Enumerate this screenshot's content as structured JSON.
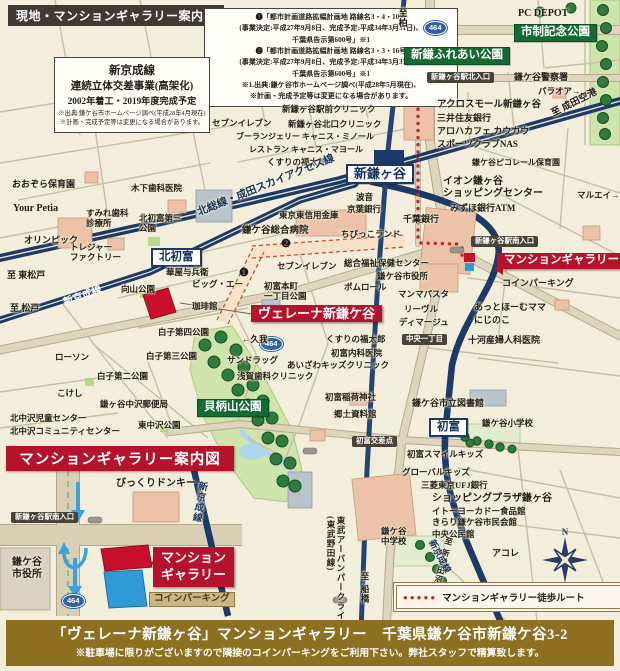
{
  "header": {
    "map_title": "現地・マンションギャラリー案内図"
  },
  "notes": {
    "roads_lines": [
      "❶「都市計画道路拡幅計画地 路線名3・4・10号",
      "(事業決定:平成27年9月8日、完成予定:平成34年3月31日)、",
      "千葉県告示第600号」※1",
      "❷「都市計画道路拡幅計画地 路線名3・3・16号",
      "(事業決定:平成27年9月8日、完成予定:平成34年3月31日)、",
      "千葉県告示第600号」※1",
      "※1.出典:鎌ケ谷市ホームページ調べ(平成28年5月現在)、",
      "※計画・完成予定等は変更になる場合があります。"
    ],
    "rail_t1": "新京成線",
    "rail_t2": "連続立体交差事業(高架化)",
    "rail_t3": "2002年着工・2019年度完成予定",
    "rail_small": [
      "※出典:鎌ケ谷市ホームページ調べ(平成28年4月現在)",
      "※計画・完成予定等は変更になる場合があります。"
    ]
  },
  "inset": {
    "title": "マンションギャラリー案内図",
    "gallery_label": "マンション\nギャラリー"
  },
  "legend": {
    "dots": "●●●●●",
    "text": "マンションギャラリー徒歩ルート"
  },
  "compass": {
    "n": "N"
  },
  "footer": {
    "line1": "「ヴェレーナ新鎌ヶ谷」マンションギャラリー　千葉県鎌ケ谷市新鎌ケ谷3-2",
    "line2": "※駐車場に限りがございますので隣接のコインパーキングをご利用下さい。弊社スタッフで精算致します。"
  },
  "colors": {
    "rail_navy": "#1d3a66",
    "route_red": "#c32b2b",
    "site_red": "#c8102e",
    "accent_crimson": "#b5122b",
    "park_green": "#cfe3ad",
    "label_green_bg": "#156a33",
    "badge_dark": "#494337",
    "footer_gold": "#8d7021",
    "coin_blue": "#2e9bd6",
    "shield_blue": "#2f61a8",
    "bg_cream": "#f3eedb"
  },
  "labels": [
    {
      "t": "PC DEPOT",
      "x": 518,
      "y": 8,
      "fs": 10,
      "cls": "b"
    },
    {
      "t": "市制記念公園",
      "x": 514,
      "y": 24,
      "cls": "green",
      "n": "park-label-shisei-kinen"
    },
    {
      "t": "新鎌ふれあい公園",
      "x": 404,
      "y": 47,
      "cls": "green",
      "n": "park-label-shinkama-fureai"
    },
    {
      "t": "貝柄山公園",
      "x": 197,
      "y": 399,
      "cls": "green",
      "n": "park-label-kaigarayama"
    },
    {
      "t": "新鎌ヶ谷",
      "x": 346,
      "y": 164,
      "cls": "station",
      "fs": 13,
      "n": "station-shinkamagaya"
    },
    {
      "t": "北初富",
      "x": 151,
      "y": 248,
      "cls": "station",
      "fs": 11.5,
      "n": "station-kitahatsutomi"
    },
    {
      "t": "初富",
      "x": 429,
      "y": 418,
      "cls": "station",
      "fs": 11.5,
      "n": "station-hatsutomi"
    },
    {
      "t": "新鎌ヶ谷駅北入口",
      "x": 427,
      "y": 72,
      "cls": "badge",
      "n": "intersection-badge-north"
    },
    {
      "t": "新鎌ヶ谷駅南入口",
      "x": 471,
      "y": 236,
      "cls": "badge",
      "n": "intersection-badge-south"
    },
    {
      "t": "中央一丁目",
      "x": 402,
      "y": 334,
      "cls": "badge",
      "n": "intersection-badge-chuo"
    },
    {
      "t": "初富交差点",
      "x": 352,
      "y": 436,
      "cls": "badge",
      "n": "intersection-badge-hatsutomi"
    },
    {
      "t": "新鎌ヶ谷駅南入口",
      "x": 11,
      "y": 512,
      "cls": "badge",
      "n": "intersection-badge-south-inset"
    },
    {
      "t": "ヴェレーナ新鎌ケ谷",
      "x": 251,
      "y": 305,
      "cls": "red",
      "fs": 13,
      "n": "property-label"
    },
    {
      "t": "マンションギャラリー",
      "x": 497,
      "y": 253,
      "cls": "red pt-left",
      "fs": 11.5,
      "n": "gallery-label"
    },
    {
      "t": "コインパーキング",
      "x": 149,
      "y": 592,
      "cls": "tanbadge",
      "n": "coin-parking-label-inset"
    },
    {
      "t": "464",
      "x": 424,
      "y": 21,
      "cls": "shield",
      "n": "route-shield-464"
    },
    {
      "t": "464",
      "x": 260,
      "y": 337,
      "cls": "shield",
      "n": "route-shield-464"
    },
    {
      "t": "464",
      "x": 62,
      "y": 594,
      "cls": "shield",
      "n": "route-shield-464"
    },
    {
      "t": "❶",
      "x": 239,
      "y": 267,
      "cls": "circ",
      "n": "plan-marker-1"
    },
    {
      "t": "❷",
      "x": 281,
      "y": 238,
      "cls": "circ",
      "n": "plan-marker-2"
    },
    {
      "t": "鎌ケ谷警察署",
      "x": 514,
      "y": 72,
      "fs": 9
    },
    {
      "t": "パラオア→",
      "x": 538,
      "y": 86
    },
    {
      "t": "アクロスモール新鎌ヶ谷",
      "x": 437,
      "y": 100,
      "fs": 9.5
    },
    {
      "t": "三井住友銀行",
      "x": 437,
      "y": 113,
      "fs": 9
    },
    {
      "t": "アロハカフェ カウカウ",
      "x": 437,
      "y": 126,
      "fs": 9
    },
    {
      "t": "スポーツクラブNAS",
      "x": 437,
      "y": 139,
      "fs": 9
    },
    {
      "t": "鎌ケ谷ピコレール保育園",
      "x": 472,
      "y": 158,
      "fs": 8
    },
    {
      "t": "マルエイ→",
      "x": 577,
      "y": 190
    },
    {
      "t": "イオン鎌ヶ谷\nショッピングセンター",
      "x": 443,
      "y": 176,
      "fs": 10
    },
    {
      "t": "みずほ銀行ATM",
      "x": 450,
      "y": 203,
      "fs": 9
    },
    {
      "t": "千葉銀行",
      "x": 403,
      "y": 214,
      "fs": 9
    },
    {
      "t": "波音",
      "x": 356,
      "y": 192
    },
    {
      "t": "京葉銀行",
      "x": 347,
      "y": 204
    },
    {
      "t": "東京東信用金庫",
      "x": 279,
      "y": 210
    },
    {
      "t": "鎌ケ谷総合病院",
      "x": 242,
      "y": 226,
      "fs": 9.5
    },
    {
      "t": "ちびっこランド",
      "x": 341,
      "y": 229
    },
    {
      "t": "セブンイレブン",
      "x": 212,
      "y": 118
    },
    {
      "t": "新鎌ヶ谷駅前クリニック",
      "x": 282,
      "y": 104
    },
    {
      "t": "新鎌ヶ谷北口クリニック",
      "x": 288,
      "y": 119
    },
    {
      "t": "ブーランジェリー キャニス・ミノール",
      "x": 236,
      "y": 132,
      "fs": 8
    },
    {
      "t": "レストラン キャニス・マヨール",
      "x": 249,
      "y": 145,
      "fs": 8
    },
    {
      "t": "くすりの福太郎",
      "x": 267,
      "y": 157
    },
    {
      "t": "至 成田空港",
      "x": 550,
      "y": 110,
      "fs": 9.5,
      "rot": -27,
      "cls": "b"
    },
    {
      "t": "至柏",
      "x": 397,
      "y": 8,
      "fs": 9,
      "cls": "vtext b"
    },
    {
      "t": "至 東松戸",
      "x": 7,
      "y": 270,
      "fs": 9,
      "cls": "b"
    },
    {
      "t": "至 松戸",
      "x": 10,
      "y": 303,
      "fs": 9,
      "cls": "b"
    },
    {
      "t": "北総線・成田スカイアクセス線",
      "x": 196,
      "y": 208,
      "fs": 10.5,
      "rot": -22,
      "cls": "navy b",
      "n": "railway-label-hokuso"
    },
    {
      "t": "新京成線",
      "x": 62,
      "y": 298,
      "fs": 10,
      "rot": -20,
      "cls": "white b",
      "n": "railway-label-shinkeisei-west"
    },
    {
      "t": "おおぞら保育園",
      "x": 12,
      "y": 179,
      "fs": 9
    },
    {
      "t": "Your Petia",
      "x": 13,
      "y": 203,
      "fs": 10
    },
    {
      "t": "木下歯科医院",
      "x": 131,
      "y": 183
    },
    {
      "t": "すみれ歯科\n診療所",
      "x": 86,
      "y": 208
    },
    {
      "t": "北初富第三\n公園",
      "x": 139,
      "y": 213
    },
    {
      "t": "オリンピック",
      "x": 24,
      "y": 235,
      "fs": 9
    },
    {
      "t": "トレジャー\nファクトリー",
      "x": 70,
      "y": 242
    },
    {
      "t": "華屋与兵衛",
      "x": 166,
      "y": 267
    },
    {
      "t": "ビッグ・エー",
      "x": 192,
      "y": 279
    },
    {
      "t": "向山公園",
      "x": 121,
      "y": 284
    },
    {
      "t": "珈琲館",
      "x": 192,
      "y": 301
    },
    {
      "t": "白子第四公園",
      "x": 158,
      "y": 327
    },
    {
      "t": "白子第三公園",
      "x": 146,
      "y": 351
    },
    {
      "t": "白子第二公園",
      "x": 97,
      "y": 371
    },
    {
      "t": "ローソン",
      "x": 55,
      "y": 352
    },
    {
      "t": "こけし",
      "x": 57,
      "y": 388
    },
    {
      "t": "鎌ヶ谷中沢郵便局",
      "x": 100,
      "y": 399
    },
    {
      "t": "北中沢児童センター",
      "x": 10,
      "y": 413
    },
    {
      "t": "北中沢コミュニティセンター",
      "x": 10,
      "y": 426
    },
    {
      "t": "東中沢公園",
      "x": 138,
      "y": 420
    },
    {
      "t": "セブンイレブン",
      "x": 277,
      "y": 261
    },
    {
      "t": "総合福祉保健センター",
      "x": 344,
      "y": 258
    },
    {
      "t": "鎌ケ谷市役所",
      "x": 377,
      "y": 271
    },
    {
      "t": "ポムロール",
      "x": 344,
      "y": 282
    },
    {
      "t": "マンマパスタ",
      "x": 398,
      "y": 289
    },
    {
      "t": "リーヴル",
      "x": 404,
      "y": 304
    },
    {
      "t": "ディマージュ",
      "x": 399,
      "y": 317
    },
    {
      "t": "あっとほーむママ",
      "x": 474,
      "y": 302,
      "fs": 9
    },
    {
      "t": "にじのこ",
      "x": 474,
      "y": 315,
      "fs": 9
    },
    {
      "t": "コインパーキング",
      "x": 502,
      "y": 278,
      "fs": 9
    },
    {
      "t": "十河産婦人科医院",
      "x": 468,
      "y": 335,
      "fs": 9
    },
    {
      "t": "初富本町\n一丁目公園",
      "x": 264,
      "y": 281
    },
    {
      "t": "←久我",
      "x": 242,
      "y": 334
    },
    {
      "t": "サンドラッグ",
      "x": 227,
      "y": 355
    },
    {
      "t": "浅賀歯科クリニック",
      "x": 237,
      "y": 371
    },
    {
      "t": "くすりの福太郎",
      "x": 326,
      "y": 334
    },
    {
      "t": "初富内科医院",
      "x": 331,
      "y": 348
    },
    {
      "t": "あいざわキッズクリニック",
      "x": 287,
      "y": 360
    },
    {
      "t": "初富稲荷神社",
      "x": 325,
      "y": 392
    },
    {
      "t": "郷土資料館",
      "x": 334,
      "y": 409
    },
    {
      "t": "鎌ケ谷市立図書館",
      "x": 412,
      "y": 398,
      "fs": 9
    },
    {
      "t": "鎌ケ谷小学校",
      "x": 482,
      "y": 418
    },
    {
      "t": "初富スマイルキッズ",
      "x": 407,
      "y": 449
    },
    {
      "t": "グローバルキッズ",
      "x": 402,
      "y": 467
    },
    {
      "t": "三菱東京UFJ銀行",
      "x": 421,
      "y": 480
    },
    {
      "t": "ショッピングプラザ鎌ヶ谷",
      "x": 432,
      "y": 493,
      "fs": 10,
      "cls": "b"
    },
    {
      "t": "イトーヨーカドー食品館",
      "x": 432,
      "y": 506
    },
    {
      "t": "きらり鎌ケ谷市民会館",
      "x": 432,
      "y": 517
    },
    {
      "t": "中央公民館",
      "x": 432,
      "y": 529
    },
    {
      "t": "鎌ケ谷\n中学校",
      "x": 381,
      "y": 526
    },
    {
      "t": "アコレ",
      "x": 492,
      "y": 548,
      "fs": 9
    },
    {
      "t": "至 新津田沼",
      "x": 445,
      "y": 536,
      "fs": 8,
      "cls": "vtext",
      "rot": 15
    },
    {
      "t": "新京成線",
      "x": 436,
      "y": 538,
      "fs": 9,
      "rot": 62,
      "cls": "navy b",
      "n": "railway-label-shinkeisei-south"
    },
    {
      "t": "東武アーバンパークライン\n(東武野田線)",
      "x": 326,
      "y": 516,
      "fs": 8.5,
      "cls": "vtext b",
      "n": "railway-label-tobu"
    },
    {
      "t": "至 船橋",
      "x": 360,
      "y": 572,
      "fs": 8.5,
      "cls": "vtext"
    },
    {
      "t": "新京成線",
      "x": 196,
      "y": 480,
      "fs": 9.5,
      "cls": "vtext navy b",
      "rot": 10,
      "n": "railway-label-shinkeisei-inset"
    },
    {
      "t": "びっくりドンキー",
      "x": 116,
      "y": 478,
      "fs": 10
    },
    {
      "t": "鎌ケ谷\n市役所",
      "x": 12,
      "y": 557,
      "fs": 10
    }
  ]
}
